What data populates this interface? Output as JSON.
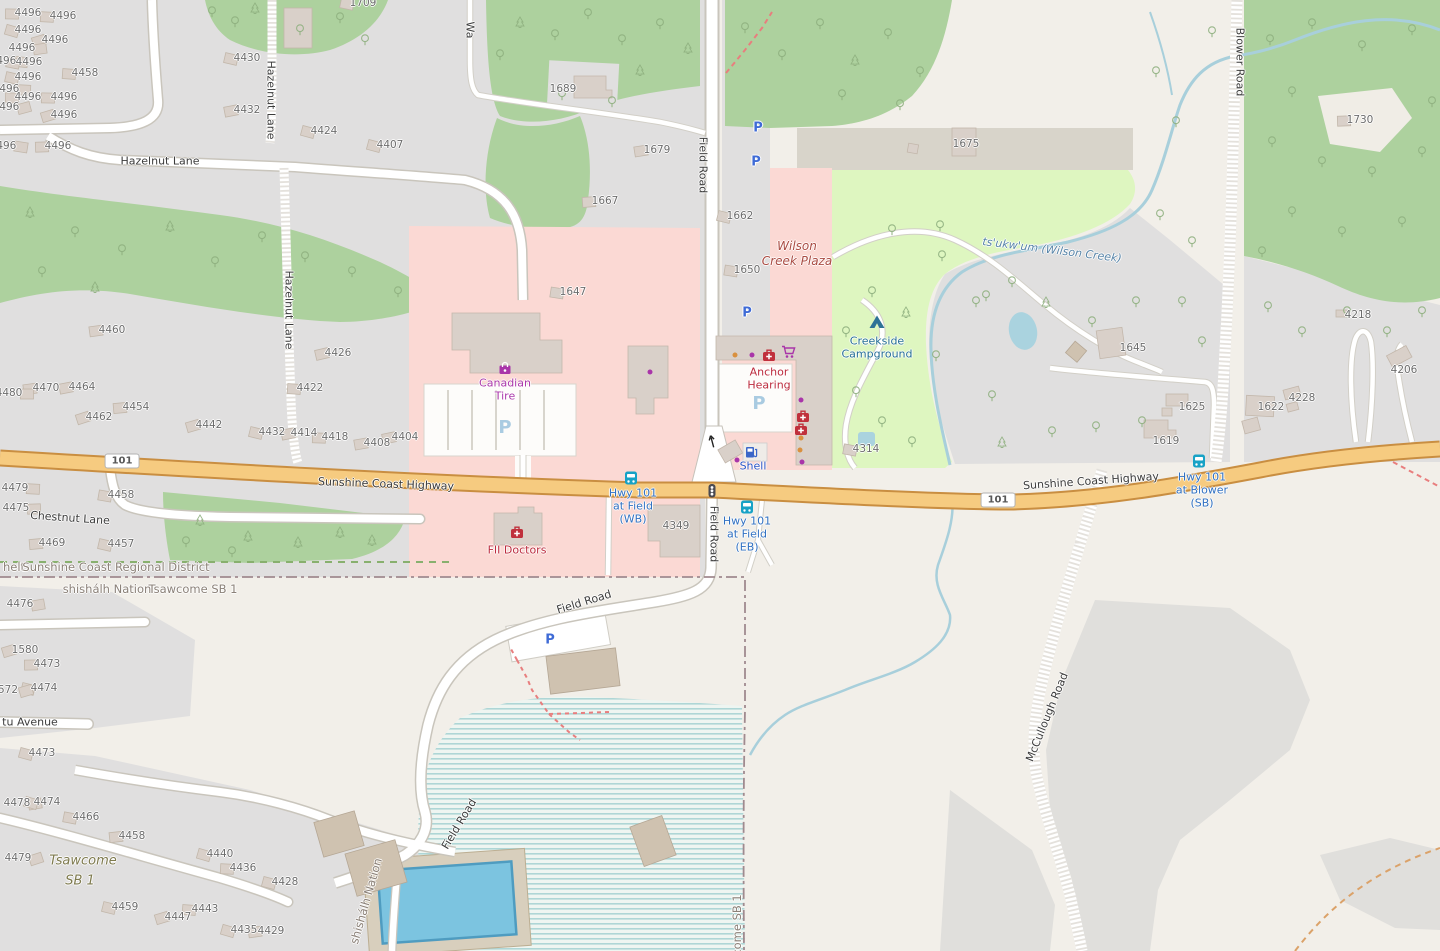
{
  "palette": {
    "background": "#f2efe9",
    "residential": "#e0dfdf",
    "retail_pink": "#fbd9d4",
    "wood_green": "#add19e",
    "campground_green": "#def6c0",
    "water_blue": "#aad3df",
    "highway_fill": "#f6cb80",
    "highway_casing": "#c98e41",
    "building": "#d9d0c9",
    "parking_blue": "#3f6bd6",
    "bus_teal": "#17a2c6",
    "shop_purple": "#ab39ab",
    "health_red": "#bc2c3e"
  },
  "map": {
    "road_labels": [
      {
        "t": "Hazelnut Lane",
        "x": 160,
        "y": 161
      },
      {
        "t": "Hazelnut Lane",
        "x": 271,
        "y": 100,
        "r": 90
      },
      {
        "t": "Hazelnut Lane",
        "x": 289,
        "y": 310,
        "r": 90
      },
      {
        "t": "Field Road",
        "x": 703,
        "y": 165,
        "r": 90
      },
      {
        "t": "Field Road",
        "x": 714,
        "y": 534,
        "r": 90
      },
      {
        "t": "Field Road",
        "x": 584,
        "y": 602,
        "r": -17
      },
      {
        "t": "Field Road",
        "x": 459,
        "y": 824,
        "r": -59
      },
      {
        "t": "Blower Road",
        "x": 1240,
        "y": 62,
        "r": 90
      },
      {
        "t": "McCullough Road",
        "x": 1047,
        "y": 717,
        "r": -68
      },
      {
        "t": "Sunshine Coast Highway",
        "x": 386,
        "y": 484,
        "r": 2
      },
      {
        "t": "Sunshine Coast Highway",
        "x": 1091,
        "y": 481,
        "r": -4
      },
      {
        "t": "Chestnut Lane",
        "x": 70,
        "y": 518,
        "r": 4
      },
      {
        "t": "Wa",
        "x": 470,
        "y": 30,
        "r": 90
      },
      {
        "t": "tu Avenue",
        "x": 30,
        "y": 722
      }
    ],
    "place_labels": [
      {
        "t": "helt",
        "x": 14,
        "y": 567
      },
      {
        "t": "Sunshine Coast Regional District",
        "x": 116,
        "y": 567
      },
      {
        "t": "shishálh Nation",
        "x": 107,
        "y": 589
      },
      {
        "t": "Tsawcome SB 1",
        "x": 193,
        "y": 589
      },
      {
        "t": "shishálh Nation",
        "x": 366,
        "y": 901,
        "r": -74
      },
      {
        "t": "come SB 1",
        "x": 737,
        "y": 925,
        "r": -90
      },
      {
        "t": "Tsawcome",
        "x": 83,
        "y": 861,
        "c": "place-olive"
      },
      {
        "t": "SB 1",
        "x": 80,
        "y": 881,
        "c": "place-olive"
      }
    ],
    "poi_labels": [
      {
        "t": "Wilson",
        "x": 797,
        "y": 246,
        "c": "poi-retail"
      },
      {
        "t": "Creek Plaza",
        "x": 797,
        "y": 261,
        "c": "poi-retail"
      },
      {
        "t": "Canadian",
        "x": 505,
        "y": 383,
        "c": "poi-shop"
      },
      {
        "t": "Tire",
        "x": 505,
        "y": 396,
        "c": "poi-shop"
      },
      {
        "t": "Anchor",
        "x": 769,
        "y": 372,
        "c": "poi-health"
      },
      {
        "t": "Hearing",
        "x": 769,
        "y": 385,
        "c": "poi-health"
      },
      {
        "t": "FII Doctors",
        "x": 517,
        "y": 550,
        "c": "poi-health"
      },
      {
        "t": "Shell",
        "x": 753,
        "y": 466,
        "c": "poi-fuel"
      },
      {
        "t": "Creekside",
        "x": 877,
        "y": 341,
        "c": "poi-camp"
      },
      {
        "t": "Campground",
        "x": 877,
        "y": 354,
        "c": "poi-camp"
      },
      {
        "t": "Hwy 101",
        "x": 633,
        "y": 493,
        "c": "poi-bus"
      },
      {
        "t": "at Field",
        "x": 633,
        "y": 506,
        "c": "poi-bus"
      },
      {
        "t": "(WB)",
        "x": 633,
        "y": 519,
        "c": "poi-bus"
      },
      {
        "t": "Hwy 101",
        "x": 747,
        "y": 521,
        "c": "poi-bus"
      },
      {
        "t": "at Field",
        "x": 747,
        "y": 534,
        "c": "poi-bus"
      },
      {
        "t": "(EB)",
        "x": 747,
        "y": 547,
        "c": "poi-bus"
      },
      {
        "t": "Hwy 101",
        "x": 1202,
        "y": 477,
        "c": "poi-bus"
      },
      {
        "t": "at Blower",
        "x": 1202,
        "y": 490,
        "c": "poi-bus"
      },
      {
        "t": "(SB)",
        "x": 1202,
        "y": 503,
        "c": "poi-bus"
      }
    ],
    "water_labels": [
      {
        "t": "ts'ukw'um (Wilson Creek)",
        "x": 1052,
        "y": 250,
        "r": 7
      }
    ],
    "shields": [
      {
        "t": "101",
        "x": 122,
        "y": 461
      },
      {
        "t": "101",
        "x": 998,
        "y": 500
      }
    ],
    "house_numbers": [
      {
        "t": "4496",
        "x": 28,
        "y": 13
      },
      {
        "t": "4496",
        "x": 63,
        "y": 16
      },
      {
        "t": "4496",
        "x": 28,
        "y": 30
      },
      {
        "t": "4496",
        "x": 55,
        "y": 40
      },
      {
        "t": "4496",
        "x": 22,
        "y": 48
      },
      {
        "t": "4496",
        "x": 3,
        "y": 61
      },
      {
        "t": "4496",
        "x": 29,
        "y": 62
      },
      {
        "t": "4496",
        "x": 28,
        "y": 77
      },
      {
        "t": "4496",
        "x": 6,
        "y": 89
      },
      {
        "t": "4496",
        "x": 28,
        "y": 97
      },
      {
        "t": "4496",
        "x": 64,
        "y": 97
      },
      {
        "t": "4496",
        "x": 6,
        "y": 107
      },
      {
        "t": "4496",
        "x": 64,
        "y": 115
      },
      {
        "t": "4496",
        "x": 3,
        "y": 146
      },
      {
        "t": "4496",
        "x": 58,
        "y": 146
      },
      {
        "t": "4458",
        "x": 85,
        "y": 73
      },
      {
        "t": "4430",
        "x": 247,
        "y": 58
      },
      {
        "t": "4432",
        "x": 247,
        "y": 110
      },
      {
        "t": "4424",
        "x": 324,
        "y": 131
      },
      {
        "t": "4407",
        "x": 390,
        "y": 145
      },
      {
        "t": "1709",
        "x": 363,
        "y": 3
      },
      {
        "t": "1689",
        "x": 563,
        "y": 89,
        "nb": 1
      },
      {
        "t": "1679",
        "x": 657,
        "y": 150
      },
      {
        "t": "1667",
        "x": 605,
        "y": 201
      },
      {
        "t": "1662",
        "x": 740,
        "y": 216
      },
      {
        "t": "1650",
        "x": 747,
        "y": 270
      },
      {
        "t": "1647",
        "x": 573,
        "y": 292
      },
      {
        "t": "1675",
        "x": 966,
        "y": 144,
        "nb": 1
      },
      {
        "t": "1730",
        "x": 1360,
        "y": 120
      },
      {
        "t": "1645",
        "x": 1133,
        "y": 348,
        "nb": 1
      },
      {
        "t": "4218",
        "x": 1358,
        "y": 315,
        "nb": 1
      },
      {
        "t": "4206",
        "x": 1404,
        "y": 370,
        "nb": 1
      },
      {
        "t": "4228",
        "x": 1302,
        "y": 398,
        "nb": 1
      },
      {
        "t": "1622",
        "x": 1271,
        "y": 407,
        "nb": 1
      },
      {
        "t": "1625",
        "x": 1192,
        "y": 407,
        "nb": 1
      },
      {
        "t": "1619",
        "x": 1166,
        "y": 441,
        "nb": 1
      },
      {
        "t": "4314",
        "x": 866,
        "y": 449
      },
      {
        "t": "4349",
        "x": 676,
        "y": 526,
        "nb": 1
      },
      {
        "t": "4460",
        "x": 112,
        "y": 330
      },
      {
        "t": "4464",
        "x": 82,
        "y": 387
      },
      {
        "t": "4470",
        "x": 46,
        "y": 388
      },
      {
        "t": "4480",
        "x": 9,
        "y": 393
      },
      {
        "t": "4426",
        "x": 338,
        "y": 353
      },
      {
        "t": "4422",
        "x": 310,
        "y": 388
      },
      {
        "t": "4454",
        "x": 136,
        "y": 407
      },
      {
        "t": "4462",
        "x": 99,
        "y": 417
      },
      {
        "t": "4442",
        "x": 209,
        "y": 425
      },
      {
        "t": "4432",
        "x": 272,
        "y": 432
      },
      {
        "t": "4414",
        "x": 304,
        "y": 433
      },
      {
        "t": "4418",
        "x": 335,
        "y": 437
      },
      {
        "t": "4408",
        "x": 377,
        "y": 443
      },
      {
        "t": "4404",
        "x": 405,
        "y": 437
      },
      {
        "t": "4479",
        "x": 15,
        "y": 488
      },
      {
        "t": "4458",
        "x": 121,
        "y": 495
      },
      {
        "t": "4475",
        "x": 16,
        "y": 508
      },
      {
        "t": "4469",
        "x": 52,
        "y": 543
      },
      {
        "t": "4457",
        "x": 121,
        "y": 544
      },
      {
        "t": "4476",
        "x": 20,
        "y": 604
      },
      {
        "t": "1580",
        "x": 25,
        "y": 650
      },
      {
        "t": "4473",
        "x": 47,
        "y": 664
      },
      {
        "t": "4474",
        "x": 44,
        "y": 688
      },
      {
        "t": "572",
        "x": 8,
        "y": 690
      },
      {
        "t": "4473",
        "x": 42,
        "y": 753
      },
      {
        "t": "4478",
        "x": 17,
        "y": 803
      },
      {
        "t": "4474",
        "x": 47,
        "y": 802
      },
      {
        "t": "4466",
        "x": 86,
        "y": 817
      },
      {
        "t": "4458",
        "x": 132,
        "y": 836
      },
      {
        "t": "4479",
        "x": 18,
        "y": 858
      },
      {
        "t": "4440",
        "x": 220,
        "y": 854
      },
      {
        "t": "4436",
        "x": 243,
        "y": 868
      },
      {
        "t": "4428",
        "x": 285,
        "y": 882
      },
      {
        "t": "4459",
        "x": 125,
        "y": 907
      },
      {
        "t": "4443",
        "x": 205,
        "y": 909
      },
      {
        "t": "4447",
        "x": 178,
        "y": 917
      },
      {
        "t": "4435",
        "x": 244,
        "y": 930
      },
      {
        "t": "4429",
        "x": 271,
        "y": 931
      }
    ],
    "icons": [
      {
        "n": "parking-icon",
        "x": 758,
        "y": 128,
        "g": "P"
      },
      {
        "n": "parking-icon",
        "x": 756,
        "y": 162,
        "g": "P"
      },
      {
        "n": "parking-icon",
        "x": 747,
        "y": 313,
        "g": "P"
      },
      {
        "n": "parking-icon",
        "x": 550,
        "y": 640,
        "g": "P"
      },
      {
        "n": "parking-lot-icon",
        "x": 505,
        "y": 428,
        "g": "P"
      },
      {
        "n": "parking-lot-icon",
        "x": 759,
        "y": 404,
        "g": "P"
      },
      {
        "n": "bus-stop-icon",
        "x": 631,
        "y": 478
      },
      {
        "n": "bus-stop-icon",
        "x": 747,
        "y": 507
      },
      {
        "n": "bus-stop-icon",
        "x": 1199,
        "y": 461
      },
      {
        "n": "traffic-signals-icon",
        "x": 712,
        "y": 491
      },
      {
        "n": "one-way-arrow-icon",
        "x": 712,
        "y": 441,
        "r": -15
      },
      {
        "n": "fuel-icon",
        "x": 752,
        "y": 452
      },
      {
        "n": "tent-icon",
        "x": 877,
        "y": 322
      },
      {
        "n": "shopping-bag-icon",
        "x": 505,
        "y": 368
      },
      {
        "n": "cart-icon",
        "x": 789,
        "y": 352
      },
      {
        "n": "medical-icon",
        "x": 769,
        "y": 355
      },
      {
        "n": "medical-icon",
        "x": 803,
        "y": 416
      },
      {
        "n": "medical-icon",
        "x": 801,
        "y": 429
      },
      {
        "n": "medical-icon",
        "x": 517,
        "y": 532
      }
    ],
    "dots": [
      {
        "x": 650,
        "y": 372,
        "c": "#a935a9"
      },
      {
        "x": 752,
        "y": 355,
        "c": "#a935a9"
      },
      {
        "x": 801,
        "y": 400,
        "c": "#a935a9"
      },
      {
        "x": 802,
        "y": 462,
        "c": "#a935a9"
      },
      {
        "x": 737,
        "y": 460,
        "c": "#a935a9"
      },
      {
        "x": 735,
        "y": 355,
        "c": "#d9903f"
      },
      {
        "x": 801,
        "y": 438,
        "c": "#d9903f"
      },
      {
        "x": 800,
        "y": 450,
        "c": "#d9903f"
      }
    ],
    "trees": [
      [
        520,
        22,
        "c"
      ],
      [
        555,
        35,
        "d"
      ],
      [
        588,
        14,
        "d"
      ],
      [
        622,
        40,
        "d"
      ],
      [
        660,
        24,
        "d"
      ],
      [
        688,
        48,
        "c"
      ],
      [
        745,
        28,
        "d"
      ],
      [
        782,
        55,
        "d"
      ],
      [
        820,
        24,
        "d"
      ],
      [
        855,
        60,
        "c"
      ],
      [
        888,
        34,
        "d"
      ],
      [
        920,
        72,
        "d"
      ],
      [
        640,
        70,
        "c"
      ],
      [
        562,
        95,
        "d"
      ],
      [
        612,
        102,
        "d"
      ],
      [
        900,
        105,
        "d"
      ],
      [
        842,
        95,
        "d"
      ],
      [
        500,
        55,
        "d"
      ],
      [
        212,
        12,
        "d"
      ],
      [
        235,
        22,
        "d"
      ],
      [
        255,
        8,
        "c"
      ],
      [
        300,
        30,
        "d"
      ],
      [
        340,
        18,
        "d"
      ],
      [
        365,
        40,
        "d"
      ],
      [
        30,
        212,
        "c"
      ],
      [
        75,
        232,
        "d"
      ],
      [
        122,
        250,
        "d"
      ],
      [
        170,
        226,
        "c"
      ],
      [
        215,
        262,
        "d"
      ],
      [
        42,
        272,
        "d"
      ],
      [
        262,
        237,
        "d"
      ],
      [
        305,
        257,
        "d"
      ],
      [
        352,
        272,
        "d"
      ],
      [
        398,
        292,
        "d"
      ],
      [
        95,
        287,
        "c"
      ],
      [
        200,
        520,
        "c"
      ],
      [
        248,
        536,
        "c"
      ],
      [
        298,
        542,
        "c"
      ],
      [
        340,
        532,
        "c"
      ],
      [
        232,
        552,
        "d"
      ],
      [
        186,
        542,
        "d"
      ],
      [
        372,
        540,
        "c"
      ],
      [
        892,
        230,
        "d"
      ],
      [
        940,
        226,
        "d"
      ],
      [
        1012,
        282,
        "d"
      ],
      [
        872,
        292,
        "d"
      ],
      [
        846,
        332,
        "d"
      ],
      [
        906,
        312,
        "c"
      ],
      [
        936,
        356,
        "d"
      ],
      [
        856,
        392,
        "d"
      ],
      [
        882,
        422,
        "d"
      ],
      [
        912,
        442,
        "d"
      ],
      [
        942,
        256,
        "d"
      ],
      [
        976,
        302,
        "d"
      ],
      [
        1270,
        40,
        "d"
      ],
      [
        1312,
        24,
        "d"
      ],
      [
        1362,
        46,
        "d"
      ],
      [
        1412,
        30,
        "d"
      ],
      [
        1292,
        92,
        "d"
      ],
      [
        1272,
        142,
        "d"
      ],
      [
        1322,
        162,
        "d"
      ],
      [
        1372,
        172,
        "d"
      ],
      [
        1422,
        152,
        "d"
      ],
      [
        1292,
        212,
        "d"
      ],
      [
        1342,
        232,
        "d"
      ],
      [
        1402,
        222,
        "d"
      ],
      [
        1432,
        102,
        "d"
      ],
      [
        1262,
        252,
        "d"
      ],
      [
        1160,
        215,
        "d"
      ],
      [
        1192,
        242,
        "d"
      ],
      [
        1156,
        72,
        "d"
      ],
      [
        1176,
        122,
        "d"
      ],
      [
        1212,
        32,
        "d"
      ],
      [
        1268,
        307,
        "d"
      ],
      [
        1302,
        332,
        "d"
      ],
      [
        1347,
        312,
        "d"
      ],
      [
        1387,
        332,
        "d"
      ],
      [
        1422,
        312,
        "d"
      ],
      [
        986,
        296,
        "d"
      ],
      [
        1046,
        302,
        "c"
      ],
      [
        1092,
        322,
        "d"
      ],
      [
        1136,
        302,
        "d"
      ],
      [
        992,
        396,
        "d"
      ],
      [
        1002,
        442,
        "c"
      ],
      [
        1052,
        432,
        "d"
      ],
      [
        1096,
        427,
        "d"
      ],
      [
        1142,
        422,
        "d"
      ],
      [
        1182,
        302,
        "d"
      ],
      [
        1202,
        342,
        "d"
      ]
    ]
  }
}
